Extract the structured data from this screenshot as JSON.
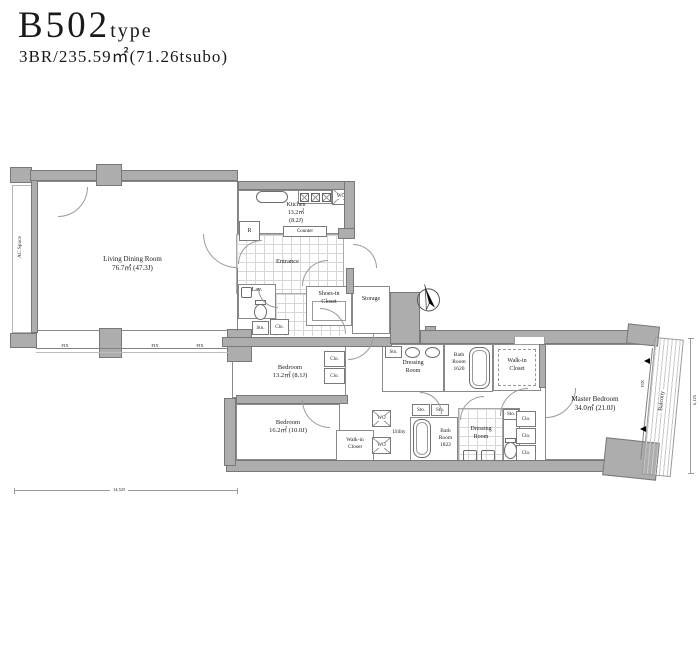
{
  "header": {
    "title": "B502",
    "title_suffix": "type",
    "subtitle": "3BR/235.59㎡(71.26tsubo)"
  },
  "rooms": {
    "ac_space": {
      "name": "AC Space"
    },
    "living": {
      "name": "Living Dining Room",
      "area": "76.7㎡  (47.3J)"
    },
    "kitchen": {
      "name": "Kitchen",
      "area": "13.2㎡",
      "tatami": "(8.2J)"
    },
    "counter": {
      "name": "Counter"
    },
    "entrance": {
      "name": "Entrance"
    },
    "lav": {
      "name": "Lav."
    },
    "shoes_closet": {
      "line1": "Shoes-in",
      "line2": "Closet"
    },
    "storage": {
      "name": "Storage"
    },
    "bedroom1": {
      "name": "Bedroom",
      "area": "13.2㎡  (8.1J)"
    },
    "bedroom2": {
      "name": "Bedroom",
      "area": "16.2㎡  (10.0J)"
    },
    "walkin_small": {
      "line1": "Walk-in",
      "line2": "Closet"
    },
    "walkin_large": {
      "line1": "Walk-in",
      "line2": "Closet"
    },
    "dressing_room_a": {
      "line1": "Dressing",
      "line2": "Room"
    },
    "bath_a": {
      "line1": "Bath",
      "line2": "Room",
      "line3": "1620"
    },
    "bath_b": {
      "line1": "Bath",
      "line2": "Room",
      "line3": "1822"
    },
    "dressing_room_b": {
      "line1": "Dressing",
      "line2": "Room"
    },
    "utility": {
      "name": "Utility"
    },
    "master": {
      "name": "Master Bedroom",
      "area": "34.0㎡  (21.0J)"
    },
    "balcony": {
      "name": "Balcony"
    }
  },
  "tags": {
    "sto": "Sto.",
    "clo": "Clo.",
    "wo": "WO",
    "refrigerator": "R",
    "fix": "FIX"
  },
  "dimensions": {
    "bottom_width": "14,525",
    "right_height": "6,125"
  }
}
